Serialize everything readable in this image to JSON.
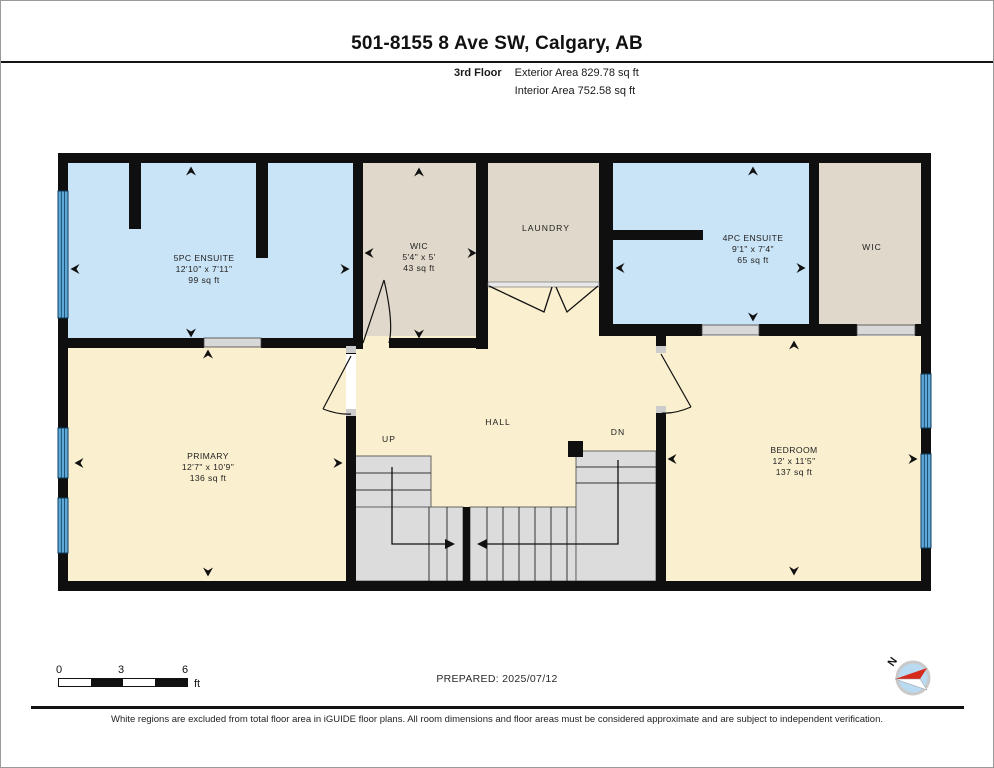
{
  "header": {
    "title": "501-8155 8 Ave SW, Calgary, AB",
    "floor_label": "3rd Floor",
    "exterior_area": "Exterior Area 829.78 sq ft",
    "interior_area": "Interior Area 752.58 sq ft"
  },
  "rooms": {
    "ensuite_5pc": {
      "name": "5PC ENSUITE",
      "dims": "12'10\" x 7'11\"",
      "area": "99 sq ft"
    },
    "wic_left": {
      "name": "WIC",
      "dims": "5'4\" x 5'",
      "area": "43 sq ft"
    },
    "laundry": {
      "name": "LAUNDRY"
    },
    "ensuite_4pc": {
      "name": "4PC ENSUITE",
      "dims": "9'1\" x 7'4\"",
      "area": "65 sq ft"
    },
    "wic_right": {
      "name": "WIC"
    },
    "primary": {
      "name": "PRIMARY",
      "dims": "12'7\" x 10'9\"",
      "area": "136 sq ft"
    },
    "hall": {
      "name": "HALL"
    },
    "bedroom": {
      "name": "BEDROOM",
      "dims": "12' x 11'5\"",
      "area": "137 sq ft"
    }
  },
  "stairs": {
    "up_label": "UP",
    "down_label": "DN"
  },
  "footer": {
    "scale": {
      "tick_start": "0",
      "tick_mid": "3",
      "tick_end": "6",
      "unit": "ft"
    },
    "prepared_label": "PREPARED: 2025/07/12",
    "compass_north_label": "N",
    "disclaimer": "White regions are excluded from total floor area in iGUIDE floor plans. All room dimensions and floor areas must be considered approximate and are subject to independent verification."
  },
  "palette": {
    "room_blue": "#c9e4f6",
    "room_beige": "#e0d9cb",
    "room_cream": "#faefce",
    "wall_black": "#0f0f0f",
    "window_blue": "#5fa9d8",
    "stair_gray": "#dcdcdc",
    "compass_blue": "#b9daf1",
    "compass_red": "#d42b1e"
  }
}
